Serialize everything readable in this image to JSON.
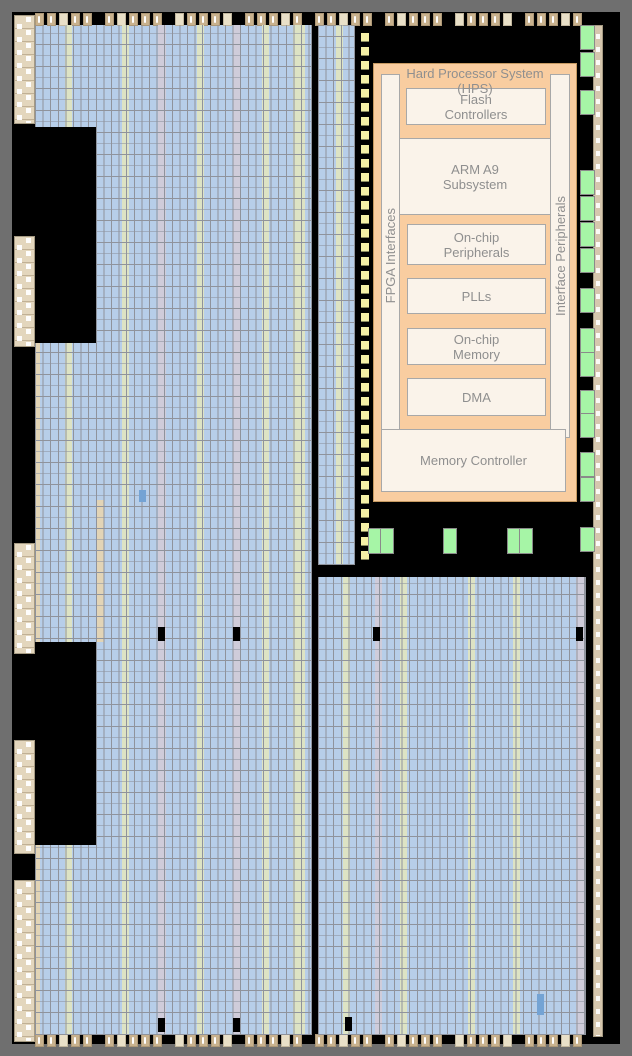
{
  "hps": {
    "title": "Hard Processor System\n(HPS)",
    "left_bar_label": "FPGA Interfaces",
    "right_bar_label": "Interface Peripherals",
    "blocks": {
      "flash": "Flash\nControllers",
      "arm": "ARM A9\nSubsystem",
      "peripherals": "On-chip\nPeripherals",
      "plls": "PLLs",
      "memory": "On-chip\nMemory",
      "dma": "DMA",
      "memory_controller": "Memory Controller"
    }
  },
  "colors": {
    "frame": "#6f6f6f",
    "die": "#000000",
    "fabric": "#b7cee9",
    "grid": "#8f939c",
    "olive": "#dde3c4",
    "lav": "#cfccda",
    "beige": "#e2d4b6",
    "io_dark": "#c9b28e",
    "io_light": "#e9e0c8",
    "yellow": "#f5f0a6",
    "green": "#a6f5a6",
    "hps_fill": "#f9cda0",
    "hps_border": "#c69a62",
    "cream": "#faf3ea",
    "blk_border": "#a8a8a8",
    "text": "#8f8f8f",
    "highlight": "#74a3d4"
  }
}
